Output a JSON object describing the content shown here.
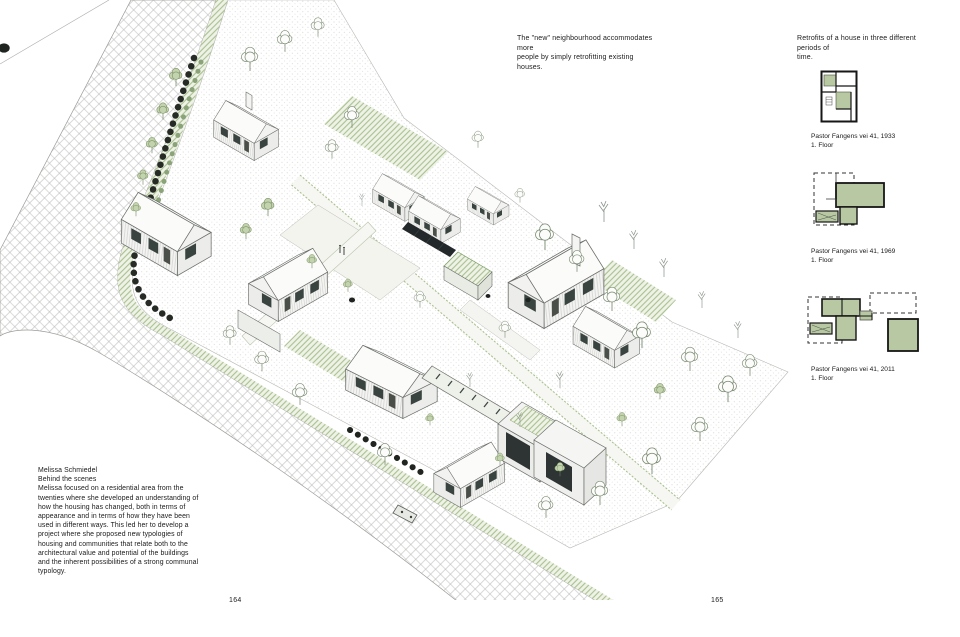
{
  "spread": {
    "left_page_number": "164",
    "right_page_number": "165"
  },
  "annotations": {
    "neighbourhood_note": [
      "The \"new\" neighbourhood accommodates more",
      "people by simply retrofitting existing houses."
    ],
    "retrofits_note": [
      "Retrofits of a house in three different periods of",
      "time."
    ]
  },
  "project_text": {
    "author": "Melissa Schmiedel",
    "title": "Behind the scenes",
    "body": "Melissa focused on a residential area from the twenties where she developed an understanding of how the housing has changed, both in terms of appearance and in terms of how they have been used in different ways. This led her to develop a project where she proposed new typologies of housing and communities that relate both to the architectural value and potential of the buildings and the inherent possibilities of a strong communal typology."
  },
  "floor_plans": [
    {
      "address": "Pastor Fangens vei 41, 1933",
      "floor": "1. Floor"
    },
    {
      "address": "Pastor Fangens vei 41, 1969",
      "floor": "1. Floor"
    },
    {
      "address": "Pastor Fangens vei 41, 2011",
      "floor": "1. Floor"
    }
  ],
  "colors": {
    "retrofit_green": "#b7c8a2",
    "landscape_green": "#a9c18e",
    "ink": "#1a1a1a"
  }
}
